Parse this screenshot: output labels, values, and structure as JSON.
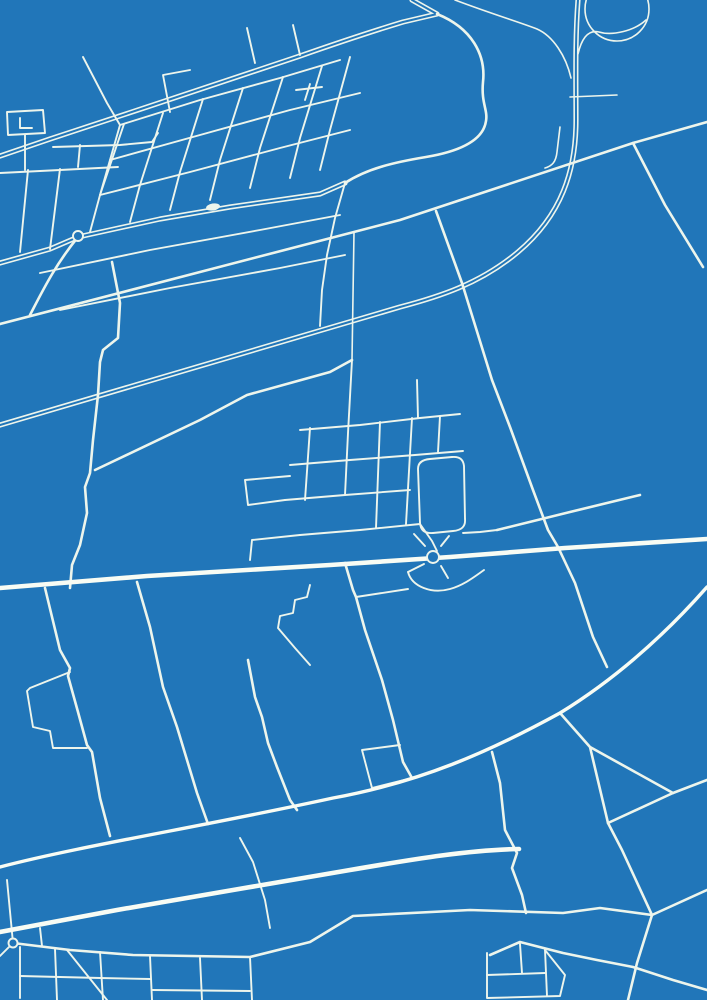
{
  "meta": {
    "kind": "map-poster",
    "style": "blueprint",
    "canvas": {
      "width": 707,
      "height": 1000
    },
    "visible_text": []
  },
  "palette": {
    "background": "#2176b9",
    "road": "#edf5ec",
    "road_bright": "#f8fcf4"
  },
  "stroke_widths": {
    "casing_outer": 5.2,
    "casing_inner": 2.0,
    "main": 4.6,
    "mainmed": 3.4,
    "medium": 2.6,
    "minor": 1.9,
    "thin": 1.6
  },
  "map": {
    "roads": [
      {
        "id": "motorway-north",
        "class": "casing",
        "d": "M 578,0 C 575,40 576,80 576,120 C 576,170 562,215 518,252 C 480,284 438,297 400,307 L 0,425"
      },
      {
        "id": "town-diagonal-double",
        "class": "casing",
        "d": "M 412,0 L 437,14 L 403,22 C 370,32 340,42 300,56 L 150,106 L 50,139 L 0,156"
      },
      {
        "id": "town-main-street",
        "class": "casing",
        "d": "M 0,263 L 50,249 L 78,237 L 160,219 L 230,207 L 320,194 L 345,183"
      },
      {
        "id": "hook-curve",
        "class": "medium",
        "d": "M 437,14 C 472,28 486,55 483,82 C 481,103 488,110 486,121 C 483,142 456,152 426,157 C 396,162 368,168 345,183"
      },
      {
        "id": "north-ramp-west",
        "class": "thin",
        "d": "M 455,0 C 492,14 522,23 537,29 C 553,36 566,56 571,78"
      },
      {
        "id": "loop-ramp",
        "class": "thin",
        "d": "M 646,20 C 634,31 612,36 599,32 C 587,29 581,41 578,54"
      },
      {
        "id": "motorway-stub-hook",
        "class": "thin",
        "d": "M 560,127 L 557,152 C 556,162 552,166 545,168"
      },
      {
        "id": "motorway-stub-east",
        "class": "thin",
        "d": "M 570,97 L 617,95"
      },
      {
        "id": "long-diagonal-upper",
        "class": "medium",
        "d": "M 0,324 L 200,272 L 400,220 L 633,143 L 707,122"
      },
      {
        "id": "branch-southeast",
        "class": "medium",
        "d": "M 633,143 L 665,205 L 703,267"
      },
      {
        "id": "long-steep-road",
        "class": "medium",
        "d": "M 436,211 L 462,283 L 492,380 L 510,427 L 533,490 L 548,530 L 558,547 L 575,583 L 593,637 L 607,667"
      },
      {
        "id": "field-stub-east",
        "class": "medium",
        "d": "M 497,530 L 570,512 L 640,495"
      },
      {
        "id": "diagonal-to-cluster",
        "class": "medium",
        "d": "M 95,470 L 200,420 L 247,395 L 330,372 L 352,360"
      },
      {
        "id": "roundabout-southwest-link",
        "class": "medium",
        "d": "M 78,237 C 55,265 42,292 30,315"
      },
      {
        "id": "windy-west-road",
        "class": "medium",
        "d": "M 112,262 L 120,303 L 118,338 L 103,350 L 100,362 L 98,395 L 93,440 L 90,473 L 85,487 L 87,513 L 80,545 L 72,565 L 70,588"
      },
      {
        "id": "west-field-road-a",
        "class": "medium",
        "d": "M 45,588 L 60,650 L 70,668 L 68,676 L 78,712 L 87,745 L 92,752 L 100,798 L 110,836"
      },
      {
        "id": "farmstead-loop",
        "class": "minor",
        "d": "M 70,672 L 30,688 L 27,691 L 33,727 L 50,731 L 53,748 L 87,748"
      },
      {
        "id": "west-field-road-b",
        "class": "medium",
        "d": "M 137,582 L 150,627 L 163,687 L 177,727 L 187,760 L 197,793 L 208,824"
      },
      {
        "id": "center-south-lane",
        "class": "medium",
        "d": "M 248,660 L 255,697 L 262,717 L 268,743 L 277,767 L 290,800 L 297,810"
      },
      {
        "id": "stair-step-lane",
        "class": "minor",
        "d": "M 310,585 L 307,597 L 295,600 L 293,613 L 280,616 L 278,628 L 295,648 L 310,665"
      },
      {
        "id": "south-connector",
        "class": "medium",
        "d": "M 345,563 L 353,590 L 356,597 L 365,630 L 382,680 L 393,720 L 403,762 L 412,778"
      },
      {
        "id": "south-connector-spur",
        "class": "minor",
        "d": "M 356,597 L 408,589"
      },
      {
        "id": "square-loop-block",
        "class": "minor",
        "d": "M 412,778 L 372,788 L 362,750 L 400,745"
      },
      {
        "id": "mid-south-vertical",
        "class": "medium",
        "d": "M 492,752 L 500,783 L 505,830 L 517,853 L 512,868 L 522,895 L 526,913"
      },
      {
        "id": "field-vertical-v1",
        "class": "minor",
        "d": "M 240,838 L 253,862 L 265,900 L 270,928"
      },
      {
        "id": "triangle-junction",
        "class": "medium",
        "d": "M 560,713 L 590,747 L 608,823 L 673,793 L 590,747"
      },
      {
        "id": "triangle-east-exit",
        "class": "medium",
        "d": "M 673,793 L 707,780"
      },
      {
        "id": "southeast-diagonal",
        "class": "medium",
        "d": "M 608,823 L 622,850 L 652,915 L 637,963 L 628,1000"
      },
      {
        "id": "south-long-road",
        "class": "medium",
        "d": "M 13,943 L 70,950 L 133,955 L 250,957 L 310,942 L 353,916 L 470,910 L 563,913 L 600,908 L 652,915 L 707,890"
      },
      {
        "id": "south-lower-road",
        "class": "medium",
        "d": "M 490,955 L 520,942 L 563,953 L 597,960 L 633,967 L 673,980 L 707,990"
      },
      {
        "id": "south-west-vertical",
        "class": "minor",
        "d": "M 7,880 L 13,943 L 0,956"
      },
      {
        "id": "grid-row-1",
        "class": "minor",
        "d": "M 120,125 L 200,100 L 280,78 L 340,60"
      },
      {
        "id": "grid-row-2",
        "class": "minor",
        "d": "M 110,160 L 200,135 L 290,110 L 360,93"
      },
      {
        "id": "grid-row-3",
        "class": "minor",
        "d": "M 100,195 L 190,172 L 280,148 L 350,130"
      },
      {
        "id": "grid-row-4",
        "class": "minor",
        "d": "M 40,273 L 150,250 L 260,230 L 340,215"
      },
      {
        "id": "grid-row-5",
        "class": "minor",
        "d": "M 60,310 L 170,288 L 280,268 L 345,255"
      },
      {
        "id": "grid-col-1",
        "class": "minor",
        "d": "M 124,124 L 100,195"
      },
      {
        "id": "grid-col-2",
        "class": "minor",
        "d": "M 163,113 L 140,185 L 130,222"
      },
      {
        "id": "grid-col-3",
        "class": "minor",
        "d": "M 203,99 L 180,172 L 170,210"
      },
      {
        "id": "grid-col-4",
        "class": "minor",
        "d": "M 243,88 L 220,160 L 210,200"
      },
      {
        "id": "grid-col-5",
        "class": "minor",
        "d": "M 283,77 L 260,148 L 250,188"
      },
      {
        "id": "grid-col-6",
        "class": "minor",
        "d": "M 322,66 L 300,138 L 290,178"
      },
      {
        "id": "grid-col-7",
        "class": "minor",
        "d": "M 350,57 L 330,130 L 320,170"
      },
      {
        "id": "nw-collector",
        "class": "minor",
        "d": "M 83,57 L 107,103 L 120,125 L 110,160 L 100,195 L 90,232"
      },
      {
        "id": "grid-stub-n1",
        "class": "minor",
        "d": "M 255,63 L 247,28"
      },
      {
        "id": "grid-stub-n2",
        "class": "minor",
        "d": "M 300,55 L 293,25"
      },
      {
        "id": "grid-stub-n3",
        "class": "minor",
        "d": "M 170,112 L 163,75 L 190,70"
      },
      {
        "id": "grid-stub-t",
        "class": "minor",
        "d": "M 305,100 L 310,84 M 296,90 L 322,87"
      },
      {
        "id": "grid-long-vertical",
        "class": "minor",
        "d": "M 345,183 L 335,218 L 327,255 L 322,290 L 320,326"
      },
      {
        "id": "west-block-outline",
        "class": "minor",
        "d": "M 7,112 L 43,110 L 45,133 L 8,135 Z"
      },
      {
        "id": "west-block-hook",
        "class": "minor",
        "d": "M 20,118 L 20,128 L 32,128"
      },
      {
        "id": "west-lane-1",
        "class": "minor",
        "d": "M 53,147 L 120,145 L 152,142 L 158,133"
      },
      {
        "id": "west-lane-2",
        "class": "minor",
        "d": "M 0,173 L 60,170 L 118,167"
      },
      {
        "id": "west-lane-link-1",
        "class": "minor",
        "d": "M 25,135 L 25,170"
      },
      {
        "id": "west-lane-link-2",
        "class": "minor",
        "d": "M 78,167 L 80,145"
      },
      {
        "id": "west-down-link-1",
        "class": "minor",
        "d": "M 28,170 L 20,252"
      },
      {
        "id": "west-down-link-2",
        "class": "minor",
        "d": "M 60,169 L 50,249"
      },
      {
        "id": "cluster-entry-vertical",
        "class": "thin",
        "d": "M 354,232 L 352,360"
      },
      {
        "id": "cluster-row-1",
        "class": "minor",
        "d": "M 300,430 L 360,425 L 420,418 L 460,414"
      },
      {
        "id": "cluster-row-2",
        "class": "minor",
        "d": "M 290,465 L 350,460 L 415,455 L 463,451"
      },
      {
        "id": "cluster-row-3",
        "class": "minor",
        "d": "M 285,500 L 345,495 L 410,490"
      },
      {
        "id": "cluster-row-4",
        "class": "minor",
        "d": "M 300,535 L 360,530 L 420,524"
      },
      {
        "id": "cluster-col-1",
        "class": "minor",
        "d": "M 352,360 L 348,433 L 345,495"
      },
      {
        "id": "cluster-col-2",
        "class": "minor",
        "d": "M 310,428 L 305,500"
      },
      {
        "id": "cluster-col-3",
        "class": "minor",
        "d": "M 380,422 L 376,528"
      },
      {
        "id": "cluster-col-4",
        "class": "minor",
        "d": "M 412,418 L 406,524"
      },
      {
        "id": "cluster-col-5",
        "class": "minor",
        "d": "M 440,416 L 438,452"
      },
      {
        "id": "cluster-col-6",
        "class": "minor",
        "d": "M 417,380 L 418,418"
      },
      {
        "id": "cluster-stadium-loop",
        "class": "minor",
        "d": "M 430,459 L 452,457 Q 463,456 464,466 L 465,519 Q 466,530 453,531 L 433,533 Q 421,534 420,523 L 418,469 Q 418,460 430,459 Z"
      },
      {
        "id": "cluster-west-block",
        "class": "minor",
        "d": "M 285,500 L 248,505 L 245,480 L 290,476"
      },
      {
        "id": "cluster-west-lane",
        "class": "minor",
        "d": "M 252,540 L 300,535 M 252,540 L 250,560"
      },
      {
        "id": "cluster-to-ring",
        "class": "minor",
        "d": "M 420,524 L 432,541 L 437,551"
      },
      {
        "id": "cluster-east-link",
        "class": "minor",
        "d": "M 463,533 L 480,532 L 497,530"
      },
      {
        "id": "ring-spoke-nw",
        "class": "minor",
        "d": "M 425,546 L 414,534"
      },
      {
        "id": "ring-spoke-ne",
        "class": "minor",
        "d": "M 441,546 L 449,536"
      },
      {
        "id": "ring-spoke-sw",
        "class": "minor",
        "d": "M 424,564 L 408,572"
      },
      {
        "id": "ring-spoke-se",
        "class": "minor",
        "d": "M 441,566 L 448,578"
      },
      {
        "id": "ring-south-loop",
        "class": "minor",
        "d": "M 408,572 C 412,587 432,594 450,589 C 464,585 474,577 484,570"
      },
      {
        "id": "southtown-col-1",
        "class": "minor",
        "d": "M 20,947 L 20,998"
      },
      {
        "id": "southtown-col-2",
        "class": "minor",
        "d": "M 55,949 L 57,1000"
      },
      {
        "id": "southtown-col-3",
        "class": "minor",
        "d": "M 100,952 L 103,1000"
      },
      {
        "id": "southtown-col-4",
        "class": "minor",
        "d": "M 150,956 L 152,1000"
      },
      {
        "id": "southtown-col-5",
        "class": "minor",
        "d": "M 200,958 L 202,1000"
      },
      {
        "id": "southtown-col-6",
        "class": "minor",
        "d": "M 250,957 L 252,1000"
      },
      {
        "id": "southtown-row-1",
        "class": "minor",
        "d": "M 20,976 L 100,978 L 150,979"
      },
      {
        "id": "southtown-row-2",
        "class": "minor",
        "d": "M 152,990 L 250,991"
      },
      {
        "id": "southtown-diagonal",
        "class": "minor",
        "d": "M 67,950 L 95,985 L 107,1000"
      },
      {
        "id": "southtown-link",
        "class": "minor",
        "d": "M 40,928 L 42,946"
      },
      {
        "id": "southcenter-block-outline",
        "class": "minor",
        "d": "M 487,953 L 487,998 L 560,996 L 565,975 L 545,950"
      },
      {
        "id": "southcenter-block-row",
        "class": "minor",
        "d": "M 487,975 L 545,973"
      },
      {
        "id": "southcenter-block-col-1",
        "class": "minor",
        "d": "M 520,944 L 522,973"
      },
      {
        "id": "southcenter-block-col-2",
        "class": "minor",
        "d": "M 545,950 L 547,996"
      },
      {
        "id": "highway-cross",
        "class": "main",
        "d": "M 0,588 L 147,576 L 330,565 L 450,557 L 565,548 L 707,539"
      },
      {
        "id": "highway-south",
        "class": "main",
        "d": "M 0,932 L 117,910 L 233,890 L 350,870 C 420,858 470,850 519,849"
      },
      {
        "id": "highway-arc-southeast",
        "class": "mainmed",
        "d": "M 0,867 C 80,846 200,827 333,798 C 420,782 487,753 560,713 C 612,681 662,638 707,587"
      }
    ],
    "roundabouts": [
      {
        "id": "roundabout-town-west",
        "cx": 78,
        "cy": 236,
        "r": 5,
        "kind": "ring"
      },
      {
        "id": "roundabout-town-blob",
        "cx": 213,
        "cy": 207,
        "rx": 7,
        "ry": 3.5,
        "rotate": -10,
        "kind": "blob"
      },
      {
        "id": "roundabout-interchange",
        "cx": 433,
        "cy": 557,
        "r": 6,
        "kind": "ring"
      },
      {
        "id": "roundabout-south",
        "cx": 13,
        "cy": 943,
        "r": 4.5,
        "kind": "ring"
      },
      {
        "id": "motorway-loop-ramp-circle",
        "cx": 617,
        "cy": 9,
        "r": 32,
        "kind": "loop"
      }
    ]
  }
}
